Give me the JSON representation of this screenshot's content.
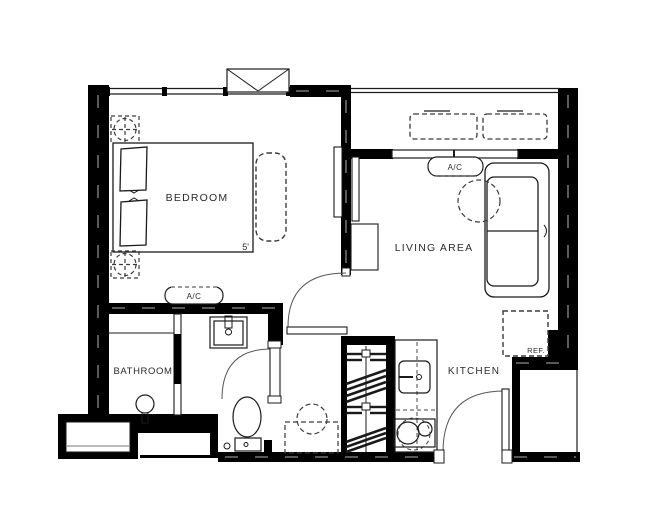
{
  "plan": {
    "title": "studio-apartment-floor-plan",
    "background": "#ffffff",
    "wall_color": "#000000",
    "line_color": "#1a1a1a",
    "dash_color": "#3a3a3a"
  },
  "rooms": {
    "bedroom": {
      "label": "BEDROOM"
    },
    "living": {
      "label": "LIVING AREA"
    },
    "bathroom": {
      "label": "BATHROOM"
    },
    "kitchen": {
      "label": "KITCHEN"
    }
  },
  "annotations": {
    "bedroom_ac": "A/C",
    "living_ac": "A/C",
    "refrigerator": "REF.",
    "bed_dimension": "5'"
  },
  "fixtures": [
    "double-bed",
    "pillows",
    "bedside-bench",
    "ceiling-fixture-symbol",
    "wall-tv-bedroom",
    "wall-tv-living",
    "tv-console",
    "l-shaped-sofa",
    "round-table",
    "balcony-planters",
    "wardrobe-closet",
    "kitchen-counter",
    "kitchen-sink",
    "two-burner-cooktop",
    "refrigerator",
    "bathroom-sink",
    "toilet",
    "shower-head",
    "shower-partition",
    "bedroom-door-swing",
    "bathroom-door-swing",
    "entry-door-swing",
    "window-box",
    "bay-window"
  ]
}
